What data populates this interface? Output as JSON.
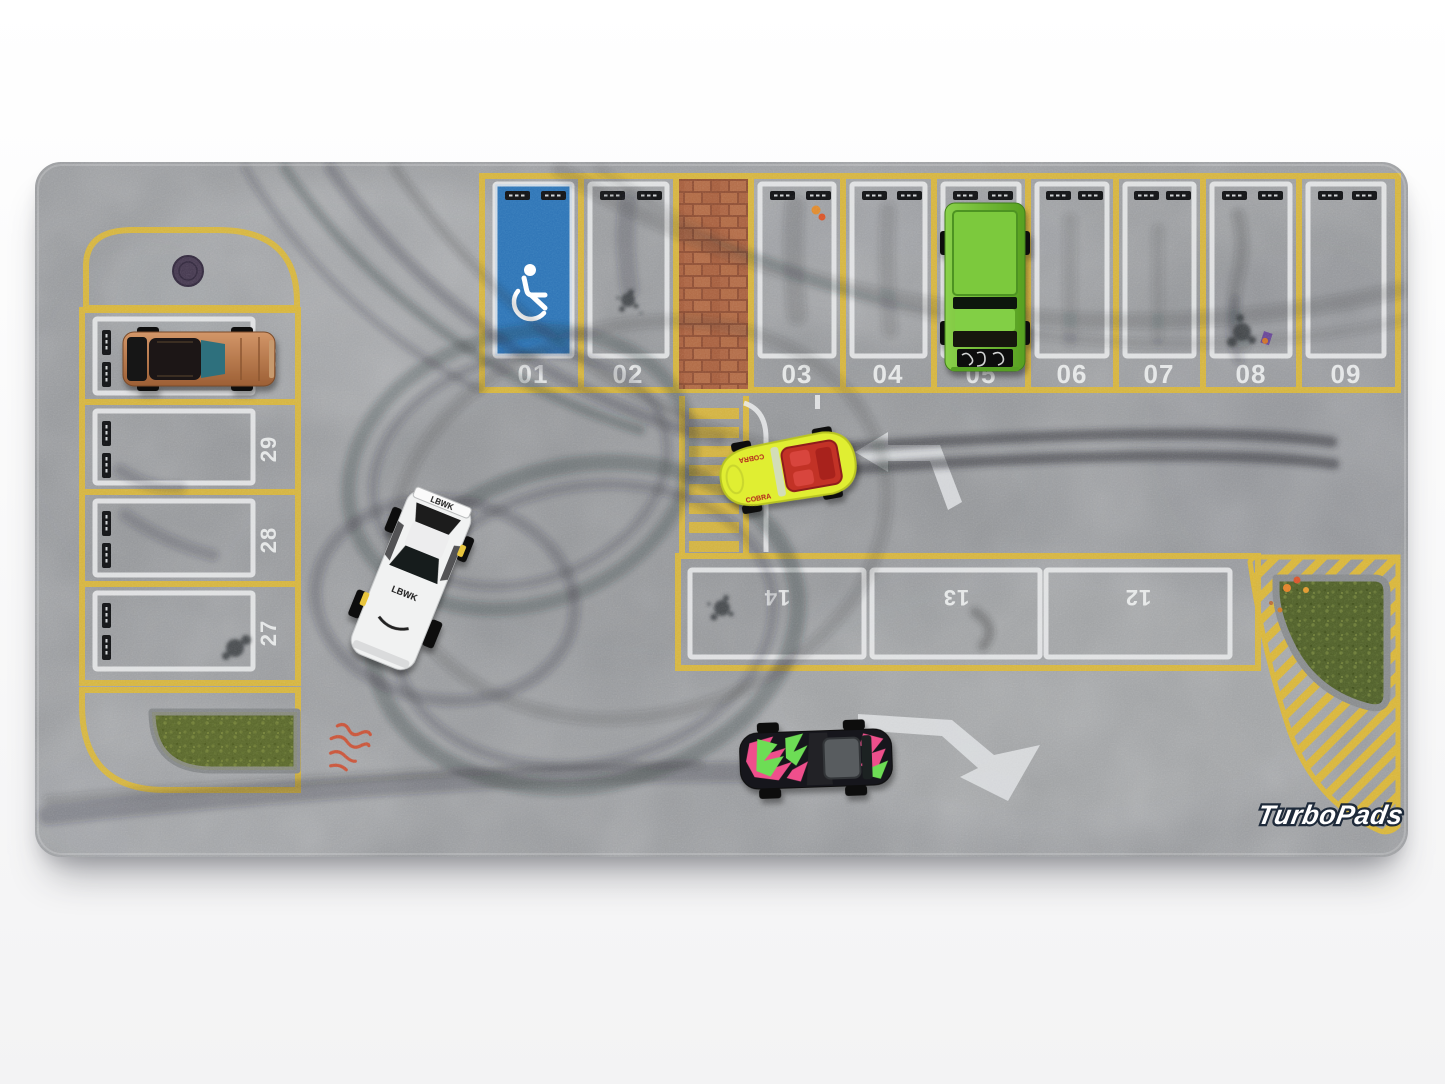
{
  "brand": {
    "logo": "TurboPads"
  },
  "parking": {
    "top_row": [
      "01",
      "02",
      "03",
      "04",
      "05",
      "06",
      "07",
      "08",
      "09"
    ],
    "left_column": [
      "30",
      "29",
      "28",
      "27"
    ],
    "middle_row": [
      "14",
      "13",
      "12"
    ]
  },
  "cars": {
    "copper_muscle_car": {
      "color": "#c08354"
    },
    "green_pickup": {
      "color": "#6fbe2f"
    },
    "yellow_cobra": {
      "color": "#e0ee33",
      "decal": "COBRA"
    },
    "white_drift_car": {
      "color": "#f1f2f2",
      "decal": "LBWK"
    },
    "black_graffiti_car": {
      "color": "#17181a"
    }
  },
  "icons": {
    "handicap": "wheelchair-icon"
  },
  "colors": {
    "asphalt": "#97999c",
    "marking_yellow": "#d8b53b",
    "marking_white": "#eaebec",
    "handicap_blue": "#2e74b6",
    "brick_red": "#a86140",
    "grass_green": "#50602a",
    "skid_dark": "#282b30",
    "graffiti_red": "#cf4626"
  }
}
